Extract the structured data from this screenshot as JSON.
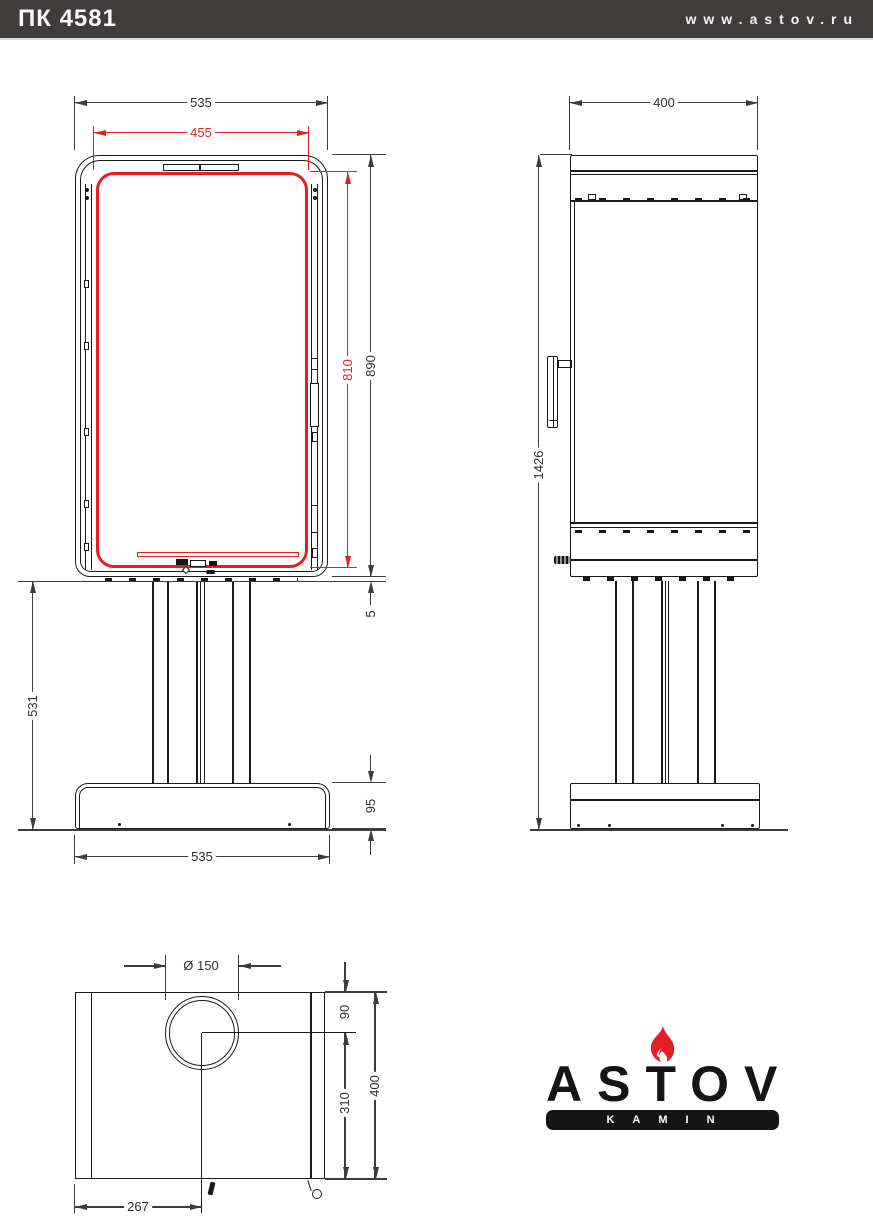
{
  "header": {
    "model": "ПК 4581",
    "website": "www.astov.ru"
  },
  "front_view": {
    "dim_width_top": "535",
    "dim_glass_width": "455",
    "dim_glass_height": "810",
    "dim_body_height": "890",
    "dim_gap": "5",
    "dim_pedestal_height": "531",
    "dim_base_height": "95",
    "dim_width_bottom": "535"
  },
  "side_view": {
    "dim_depth": "400",
    "dim_total_height": "1426"
  },
  "top_view": {
    "dim_flue_diameter": "Ø 150",
    "dim_flue_center_from_back": "90",
    "dim_flue_center_to_front": "310",
    "dim_depth": "400",
    "dim_flue_center_from_side": "267"
  },
  "logo": {
    "brand": "ASTOV",
    "tagline": "KAMIN"
  },
  "colors": {
    "accent_red": "#e31e24",
    "header_bg": "#403c3b",
    "line_black": "#1a1a1a",
    "dim_gray": "#3c3c3c"
  }
}
